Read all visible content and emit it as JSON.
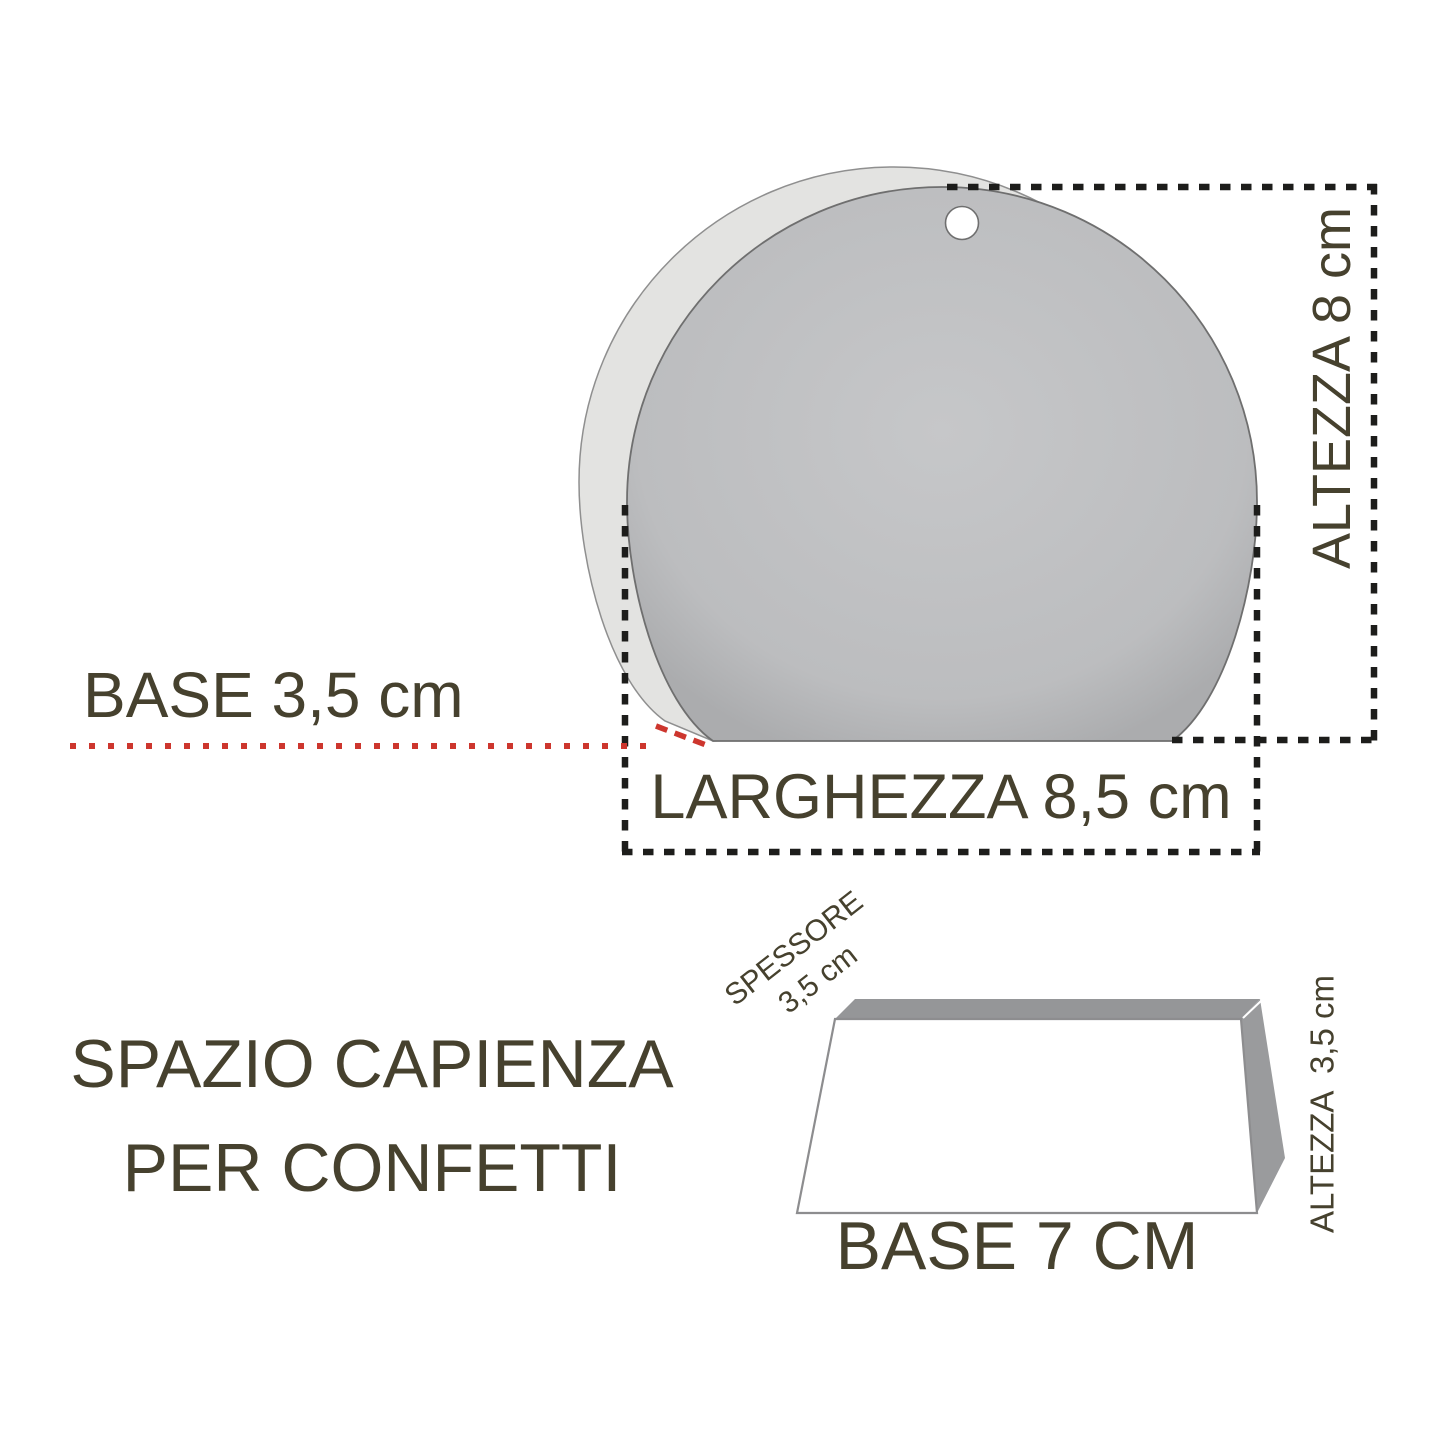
{
  "diagram": {
    "title_note": "product dimension diagram of a round favor box (scatola portaconfetti)",
    "labels": {
      "base_depth": "BASE 3,5 cm",
      "width": "LARGHEZZA 8,5 cm",
      "height": "ALTEZZA 8 cm",
      "capacity_line1": "SPAZIO CAPIENZA",
      "capacity_line2": "PER CONFETTI",
      "spessore_line1": "SPESSORE",
      "spessore_line2": "3,5 cm",
      "tray_height": "ALTEZZA  3,5 cm",
      "tray_base": "BASE 7 CM"
    },
    "dimensions_shown": {
      "pouch_base_cm": "3,5",
      "pouch_width_cm": "8,5",
      "pouch_height_cm": "8",
      "tray_thickness_cm": "3,5",
      "tray_height_cm": "3,5",
      "tray_base_cm": "7"
    },
    "colors": {
      "background": "#ffffff",
      "ink_text": "#46412e",
      "dash_black": "#1d1d1b",
      "leader_red": "#cd362e",
      "pouch_front_gray": "#bfc0c2",
      "pouch_side_light_gray": "#e3e3e1",
      "tray_face_gray": "#959698",
      "outline_gray": "#6f6f6f"
    }
  }
}
